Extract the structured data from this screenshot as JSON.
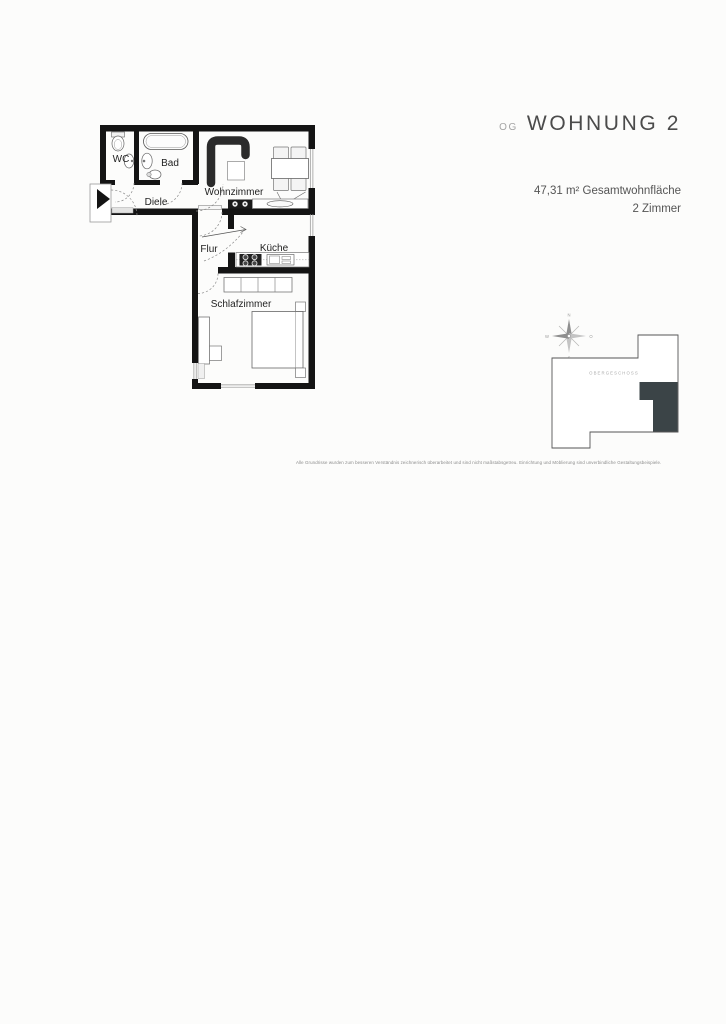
{
  "header": {
    "floor_tag": "OG",
    "title": "WOHNUNG 2",
    "area_text": "47,31 m² Gesamtwohnfläche",
    "rooms_text": "2 Zimmer"
  },
  "floorplan": {
    "labels": {
      "wc": "WC",
      "bad": "Bad",
      "diele": "Diele",
      "wohnzimmer": "Wohnzimmer",
      "flur": "Flur",
      "kueche": "Küche",
      "schlafzimmer": "Schlafzimmer"
    }
  },
  "minimap": {
    "floor_label": "OBERGESCHOSS",
    "compass": {
      "north": "N",
      "east": "O",
      "south": "S",
      "west": "W"
    }
  },
  "footer": {
    "disclaimer": "Alle Grundrisse wurden zum besseren Verständnis zeichnerisch überarbeitet und sind nicht maßstabsgetreu. Einrichtung und Möblierung sind unverbindliche Gestaltungsbeispiele."
  },
  "colors": {
    "wall": "#141414",
    "unit_highlight": "#3b4447",
    "title_text": "#4b4b4b",
    "muted_text": "#a3a3a3"
  }
}
